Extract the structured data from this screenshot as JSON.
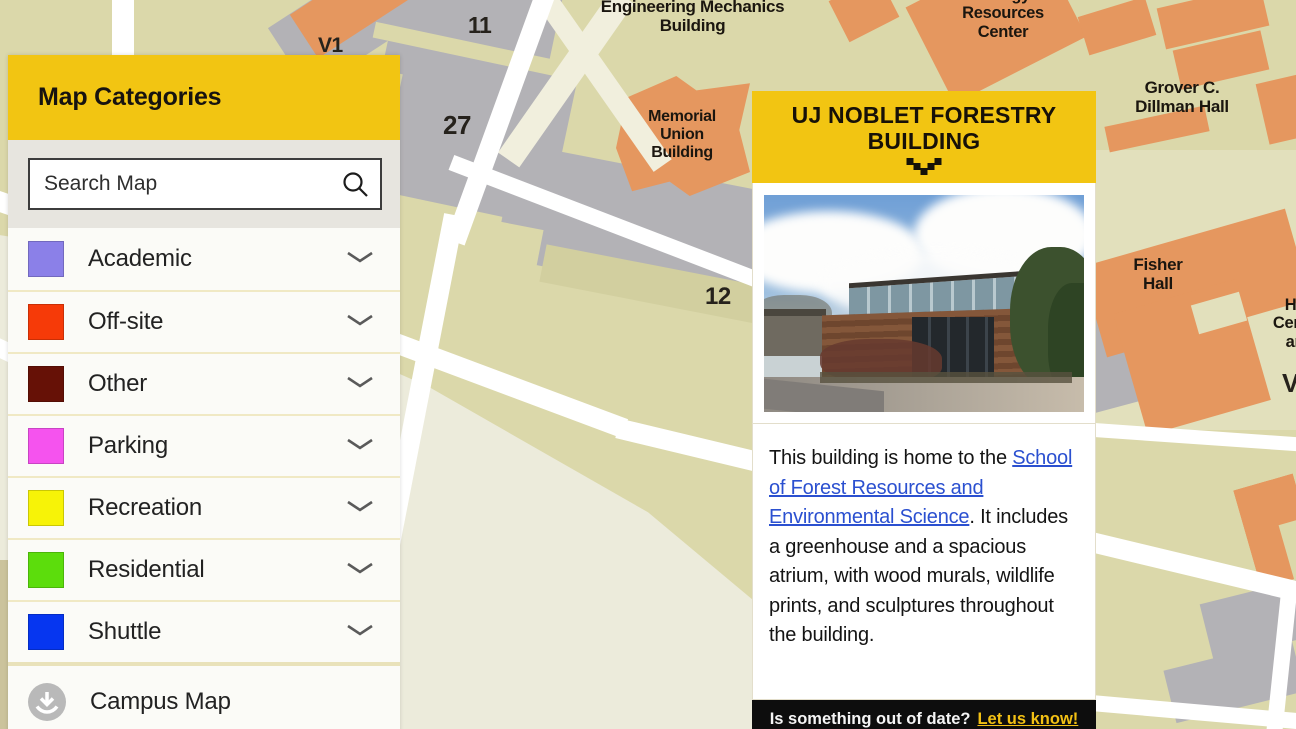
{
  "colors": {
    "accent": "#F2C512",
    "link": "#2B50D0",
    "footer_link": "#F2C014",
    "map_building": "#E5975F",
    "map_parking": "#B3B2B6",
    "road": "#FFFFFF"
  },
  "sidebar": {
    "title": "Map Categories",
    "search": {
      "placeholder": "Search Map"
    },
    "categories": [
      {
        "label": "Academic",
        "color": "#8B80E8"
      },
      {
        "label": "Off-site",
        "color": "#F63A08"
      },
      {
        "label": "Other",
        "color": "#661106"
      },
      {
        "label": "Parking",
        "color": "#F553EE"
      },
      {
        "label": "Recreation",
        "color": "#F7F307"
      },
      {
        "label": "Residential",
        "color": "#5CDD0C"
      },
      {
        "label": "Shuttle",
        "color": "#0636F0"
      }
    ],
    "campus_map": {
      "label": "Campus Map"
    }
  },
  "popup": {
    "title": "UJ NOBLET FORESTRY BUILDING",
    "description": {
      "before_link": "This building is home to the ",
      "link": "School of Forest Resources and Environmental Science",
      "after_link": ". It includes a greenhouse and a spacious atrium, with wood murals, wildlife prints, and sculptures throughout the building."
    },
    "footer": {
      "question": "Is something out of date?",
      "link": "Let us know!"
    }
  },
  "map": {
    "labels": {
      "engineering_mechanics": "Engineering Mechanics\nBuilding",
      "energy_resources": "Energy\nResources\nCenter",
      "grover_dillman": "Grover C.\nDillman Hall",
      "memorial_union": "Memorial\nUnion\nBuilding",
      "fisher_hall": "Fisher\nHall",
      "edge_fragment": "Ha\nCente\nan",
      "lot_11": "11",
      "lot_27": "27",
      "lot_12": "12",
      "lot_v1": "V1",
      "v_right": "V"
    }
  }
}
